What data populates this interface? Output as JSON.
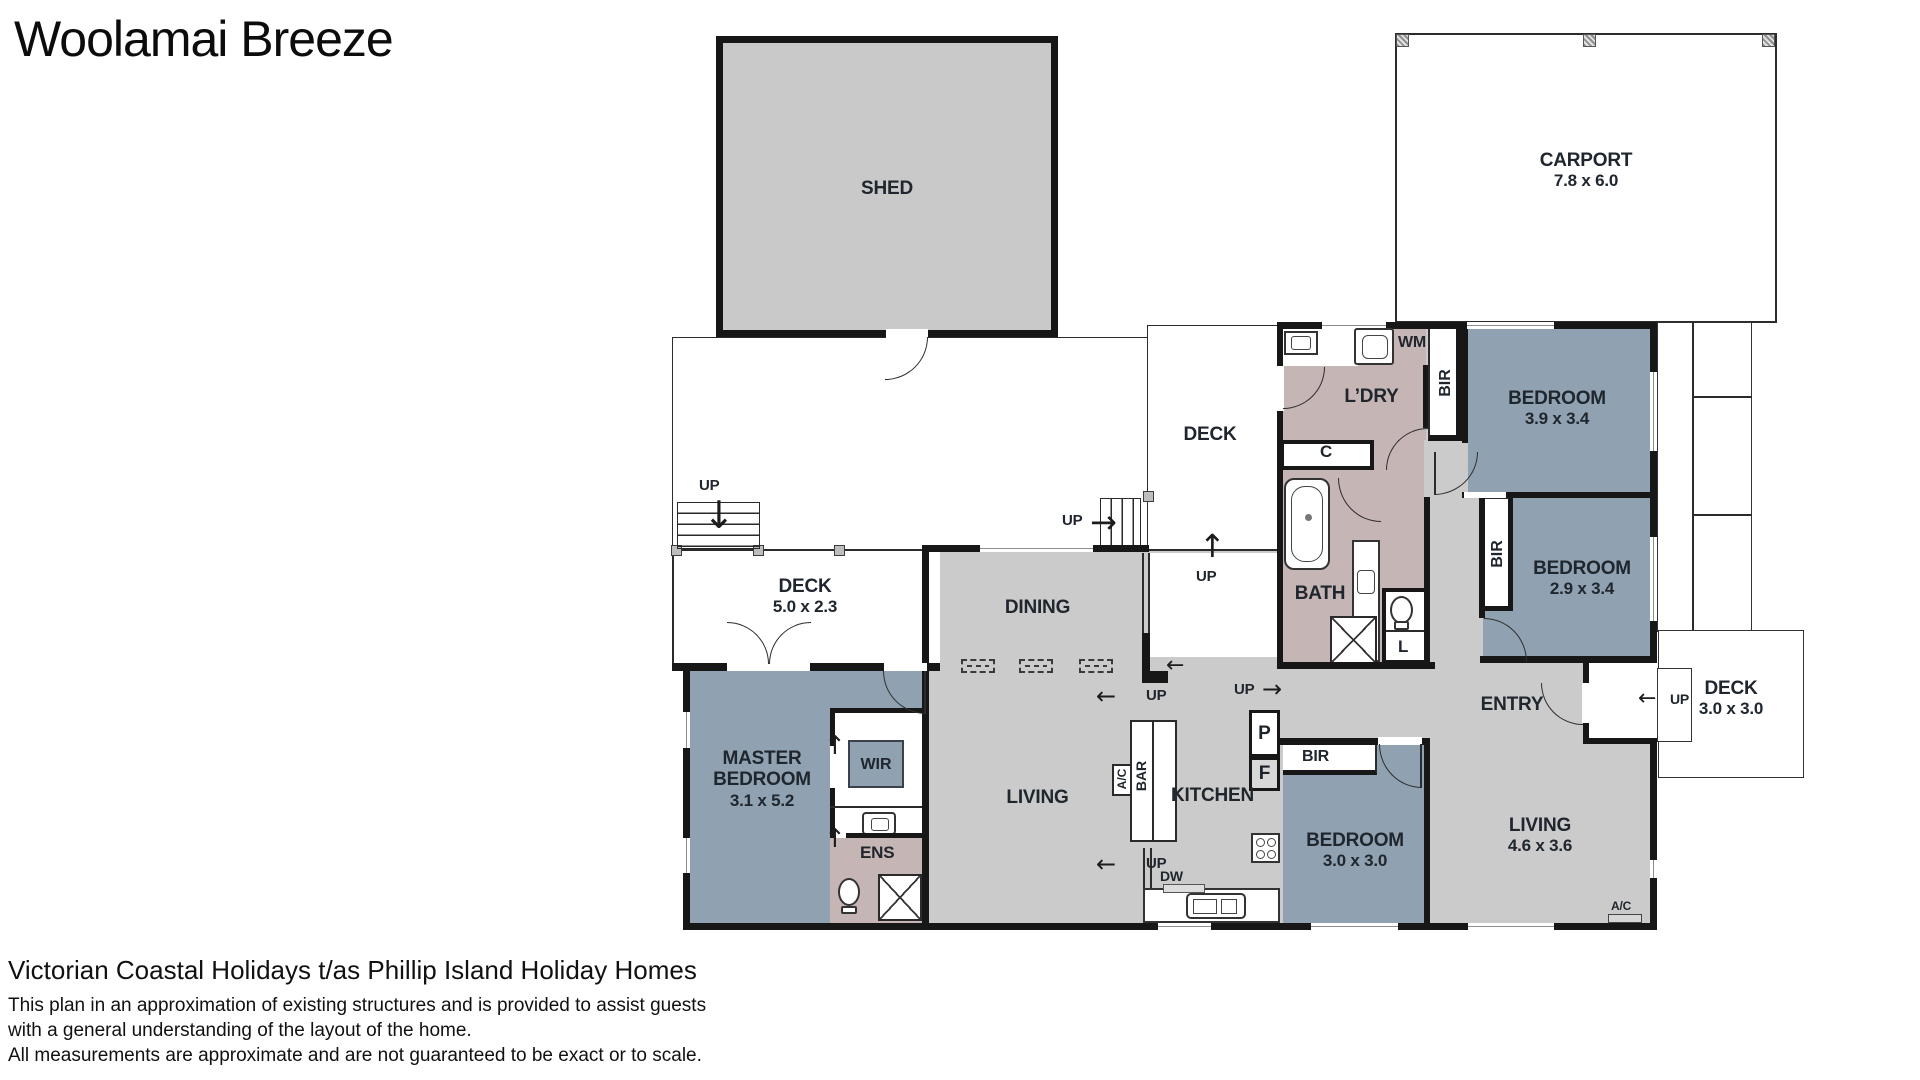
{
  "title": "Woolamai Breeze",
  "colors": {
    "bedroom_fill": "#90a2b1",
    "wet_area_fill": "#c6b5b5",
    "living_fill": "#cbcbcb",
    "shed_fill": "#c9c9ca",
    "wall": "#171717",
    "deck_fill": "#ffffff"
  },
  "rooms": {
    "shed": {
      "name": "SHED"
    },
    "carport": {
      "name": "CARPORT",
      "dims": "7.8 x 6.0"
    },
    "deck_top": {
      "name": "DECK"
    },
    "deck_left": {
      "name": "DECK",
      "dims": "5.0 x 2.3"
    },
    "deck_right": {
      "name": "DECK",
      "dims": "3.0 x 3.0"
    },
    "laundry": {
      "name": "L’DRY"
    },
    "bed1": {
      "name": "BEDROOM",
      "dims": "3.9 x 3.4"
    },
    "bed2": {
      "name": "BEDROOM",
      "dims": "2.9 x 3.4"
    },
    "bed3": {
      "name": "BEDROOM",
      "dims": "3.0 x 3.0"
    },
    "bath": {
      "name": "BATH"
    },
    "dining": {
      "name": "DINING"
    },
    "living_main": {
      "name": "LIVING"
    },
    "living2": {
      "name": "LIVING",
      "dims": "4.6 x 3.6"
    },
    "kitchen": {
      "name": "KITCHEN"
    },
    "master": {
      "name": "MASTER BEDROOM",
      "dims": "3.1 x 5.2"
    },
    "entry": {
      "name": "ENTRY"
    },
    "ens": {
      "name": "ENS"
    },
    "wir": {
      "name": "WIR"
    }
  },
  "labels": {
    "up": "UP",
    "wm": "WM",
    "c": "C",
    "l": "L",
    "p": "P",
    "f": "F",
    "bir": "BIR",
    "bar": "BAR",
    "ac": "A/C",
    "dw": "DW"
  },
  "icons": {
    "arrow_left": "←",
    "arrow_right": "→",
    "arrow_up": "↑",
    "arrow_down": "↓"
  },
  "footer": {
    "company": "Victorian Coastal Holidays t/as Phillip Island Holiday Homes",
    "line1": "This plan in an approximation of existing structures and is provided to assist guests",
    "line2": "with a general understanding of the layout of the home.",
    "line3": "All measurements are approximate and are not guaranteed to be exact or to scale."
  }
}
